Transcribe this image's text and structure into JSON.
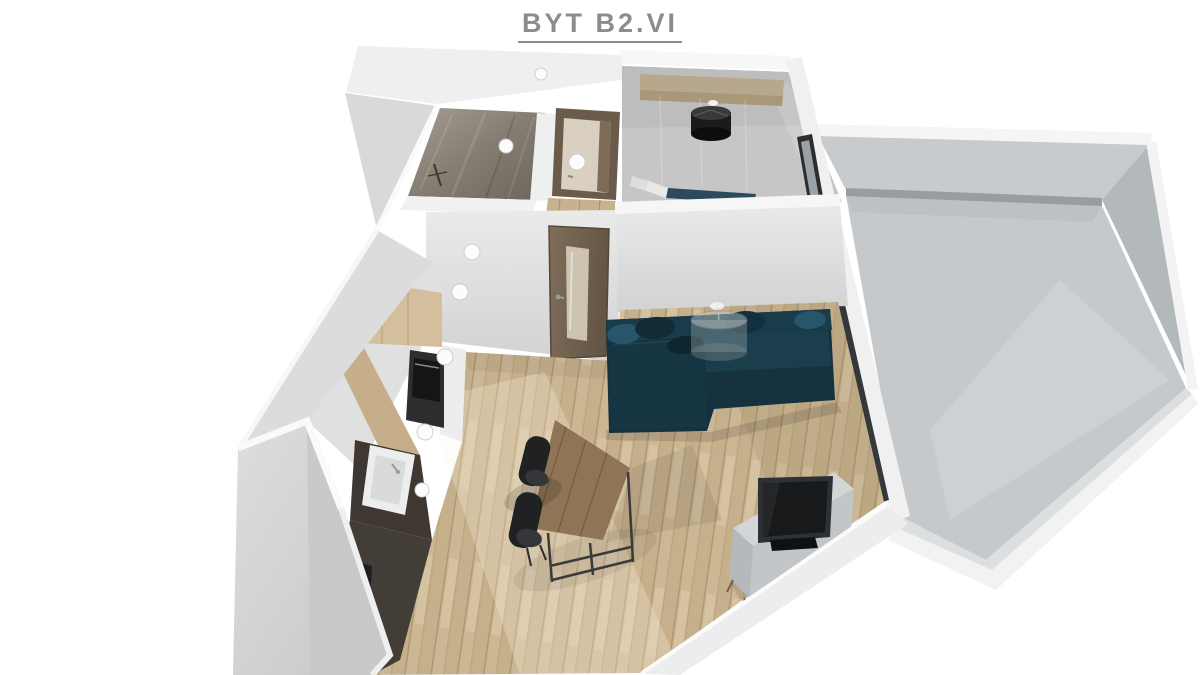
{
  "title": "BYT B2.VI",
  "colors": {
    "title-grey": "#8c8c8c",
    "wall-white": "#f2f2f2",
    "wall-shade": "#d5d5d5",
    "floor-wood": "#ccb795",
    "floor-wood-dark": "#a8906c",
    "kitchen-wood": "#d3bf9d",
    "kitchen-floor-dark": "#433d37",
    "bath-tile": "#7d766c",
    "terrace-floor": "#c5c9cc",
    "sofa-teal": "#16323e",
    "door-wood": "#74644f",
    "table-wood": "#8f7555",
    "tv-black": "#2e3133",
    "chair-black": "#1f2123",
    "lamp-black": "#1b1b1d",
    "bed-blue": "#2c4a5c"
  }
}
